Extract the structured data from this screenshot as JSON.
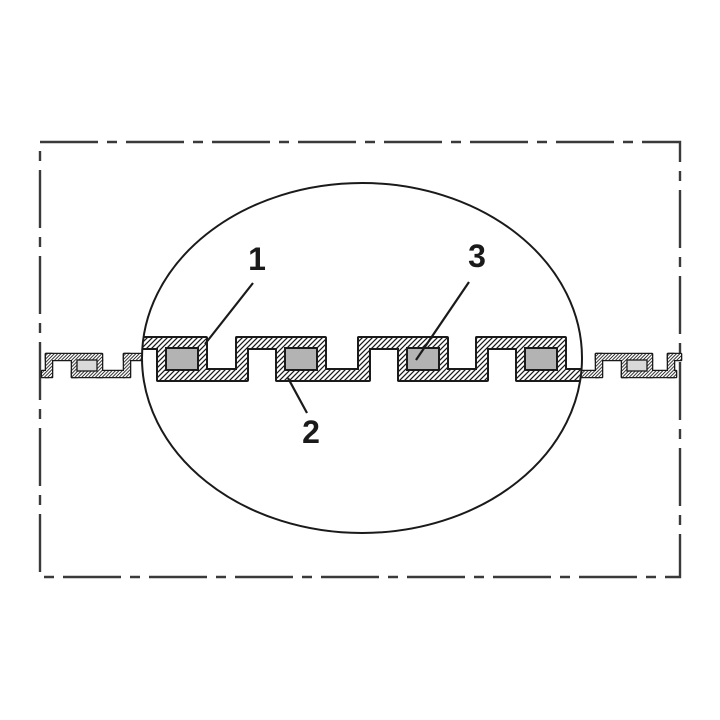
{
  "figure": {
    "callouts": [
      {
        "label": "1"
      },
      {
        "label": "2"
      },
      {
        "label": "3"
      }
    ],
    "colors": {
      "line": "#1a1a1a",
      "border": "#3a3a3a",
      "wire_fill_large": "#b3b3b3",
      "wire_fill_small": "#d9d9d9",
      "background": "#ffffff"
    }
  }
}
